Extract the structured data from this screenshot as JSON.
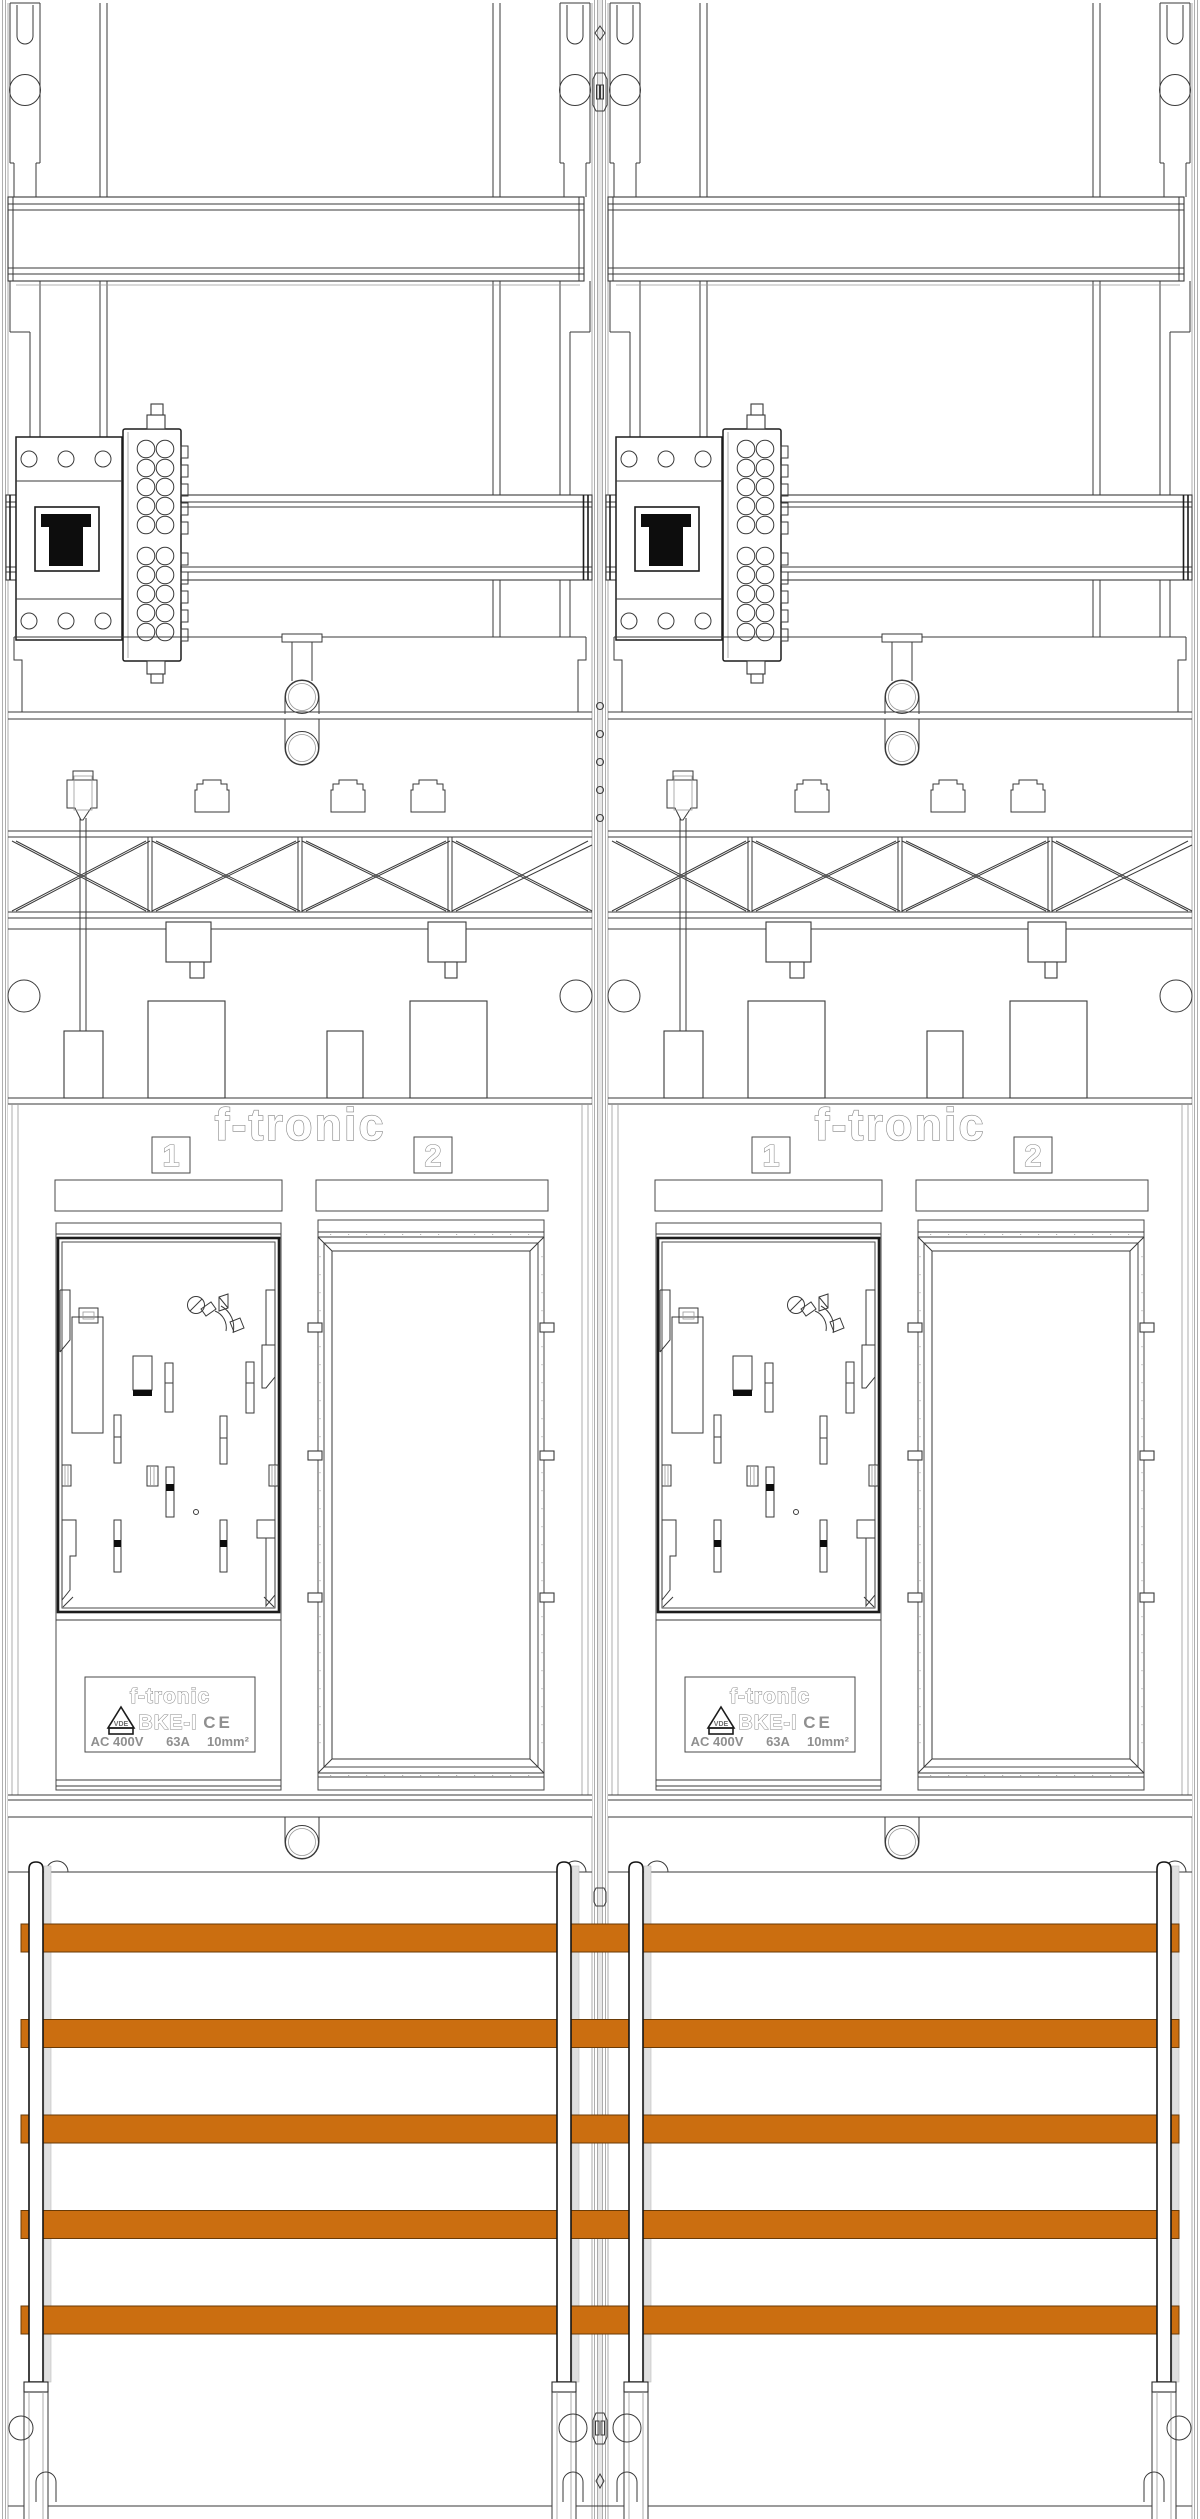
{
  "document": {
    "type": "technical-drawing",
    "background_color": "#ffffff",
    "line_color": "#3a3a3a",
    "description": "Two-bay f-tronic meter cabinet front-view section drawing"
  },
  "branding": {
    "logo_text": "f-tronic"
  },
  "bays": {
    "count": 2
  },
  "meter_fields": [
    {
      "number": "1"
    },
    {
      "number": "2"
    }
  ],
  "rating_label": {
    "brand": "f-tronic",
    "model": "BKE-I",
    "vde_mark": "VDE",
    "ce_mark": "CE",
    "voltage": "AC 400V",
    "current": "63A",
    "cross_section": "10mm²"
  },
  "busbars": {
    "count": 5,
    "color": "#cb6e10",
    "edge_color": "#6a3a06",
    "x": 21,
    "width": 1158,
    "first_y": 1924,
    "pitch": 95.5,
    "height": 28
  },
  "busbar_supports": {
    "xs": [
      29,
      557,
      629,
      1157
    ],
    "width": 14,
    "top_y": 1862,
    "bottom_y": 2382,
    "foot_height": 10,
    "color": "#ffffff",
    "shadow_color": "#e0e0e0"
  }
}
